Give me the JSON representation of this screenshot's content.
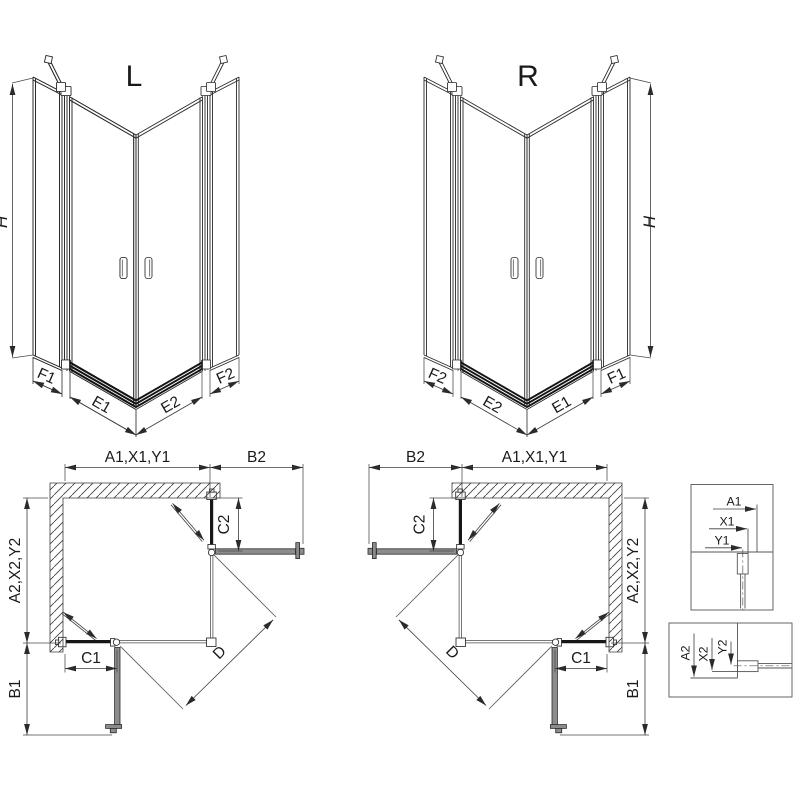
{
  "drawing": {
    "iso_left": {
      "title": "L",
      "height": "H",
      "segments": {
        "f1": "F1",
        "e1": "E1",
        "e2": "E2",
        "f2": "F2"
      }
    },
    "iso_right": {
      "title": "R",
      "height": "H",
      "segments": {
        "f2": "F2",
        "e2": "E2",
        "e1": "E1",
        "f1": "F1"
      }
    },
    "plan_left": {
      "width_top": "A1,X1,Y1",
      "extension_top": "B2",
      "depth_side": "A2,X2,Y2",
      "extension_side": "B1",
      "fixed_side": "C2",
      "fixed_bottom": "C1",
      "diagonal": "D"
    },
    "plan_right": {
      "width_top": "A1,X1,Y1",
      "extension_top": "B2",
      "depth_side": "A2,X2,Y2",
      "extension_side": "B1",
      "fixed_side": "C2",
      "fixed_bottom": "C1",
      "diagonal": "D"
    },
    "detail_top": {
      "wall": "A1",
      "profile": "X1",
      "glass_axis": "Y1"
    },
    "detail_bottom": {
      "wall": "A2",
      "profile": "X2",
      "glass_axis": "Y2"
    }
  }
}
